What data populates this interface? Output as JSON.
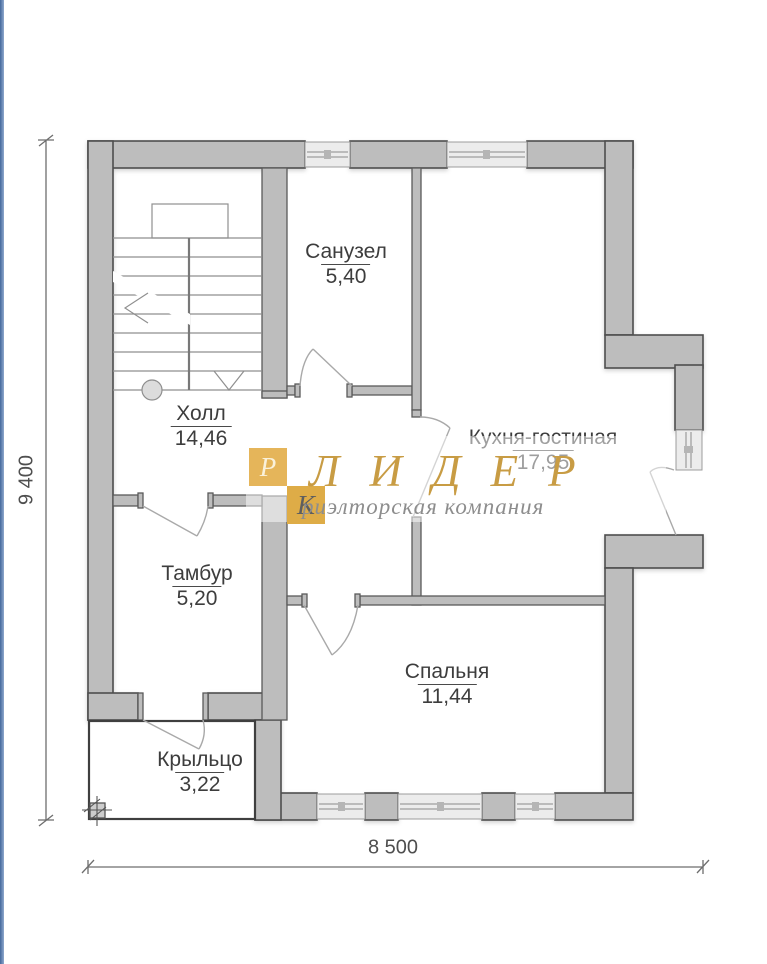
{
  "page": {
    "left_stripe_color": "#44689C",
    "background": "#FFFFFF"
  },
  "plan": {
    "type": "floor-plan",
    "wall_fill": "#BDBDBD",
    "wall_stroke": "#4E4E4E",
    "window_fill": "#ECECEC"
  },
  "rooms": [
    {
      "name": "Санузел",
      "area": "5,40"
    },
    {
      "name": "Холл",
      "area": "14,46"
    },
    {
      "name": "Кухня-гостиная",
      "area": "17,95"
    },
    {
      "name": "Тамбур",
      "area": "5,20"
    },
    {
      "name": "Спальня",
      "area": "11,44"
    },
    {
      "name": "Крыльцо",
      "area": "3,22"
    }
  ],
  "dimensions": {
    "vertical": "9 400",
    "horizontal": "8 500"
  },
  "watermark": {
    "monogram_top": "Р",
    "monogram_bottom": "К",
    "brand": "ЛИДЕР",
    "tagline": "риэлторская компания",
    "gold": "#E2B152",
    "brand_color": "#C89C44",
    "tagline_color": "#8D8D8D"
  }
}
